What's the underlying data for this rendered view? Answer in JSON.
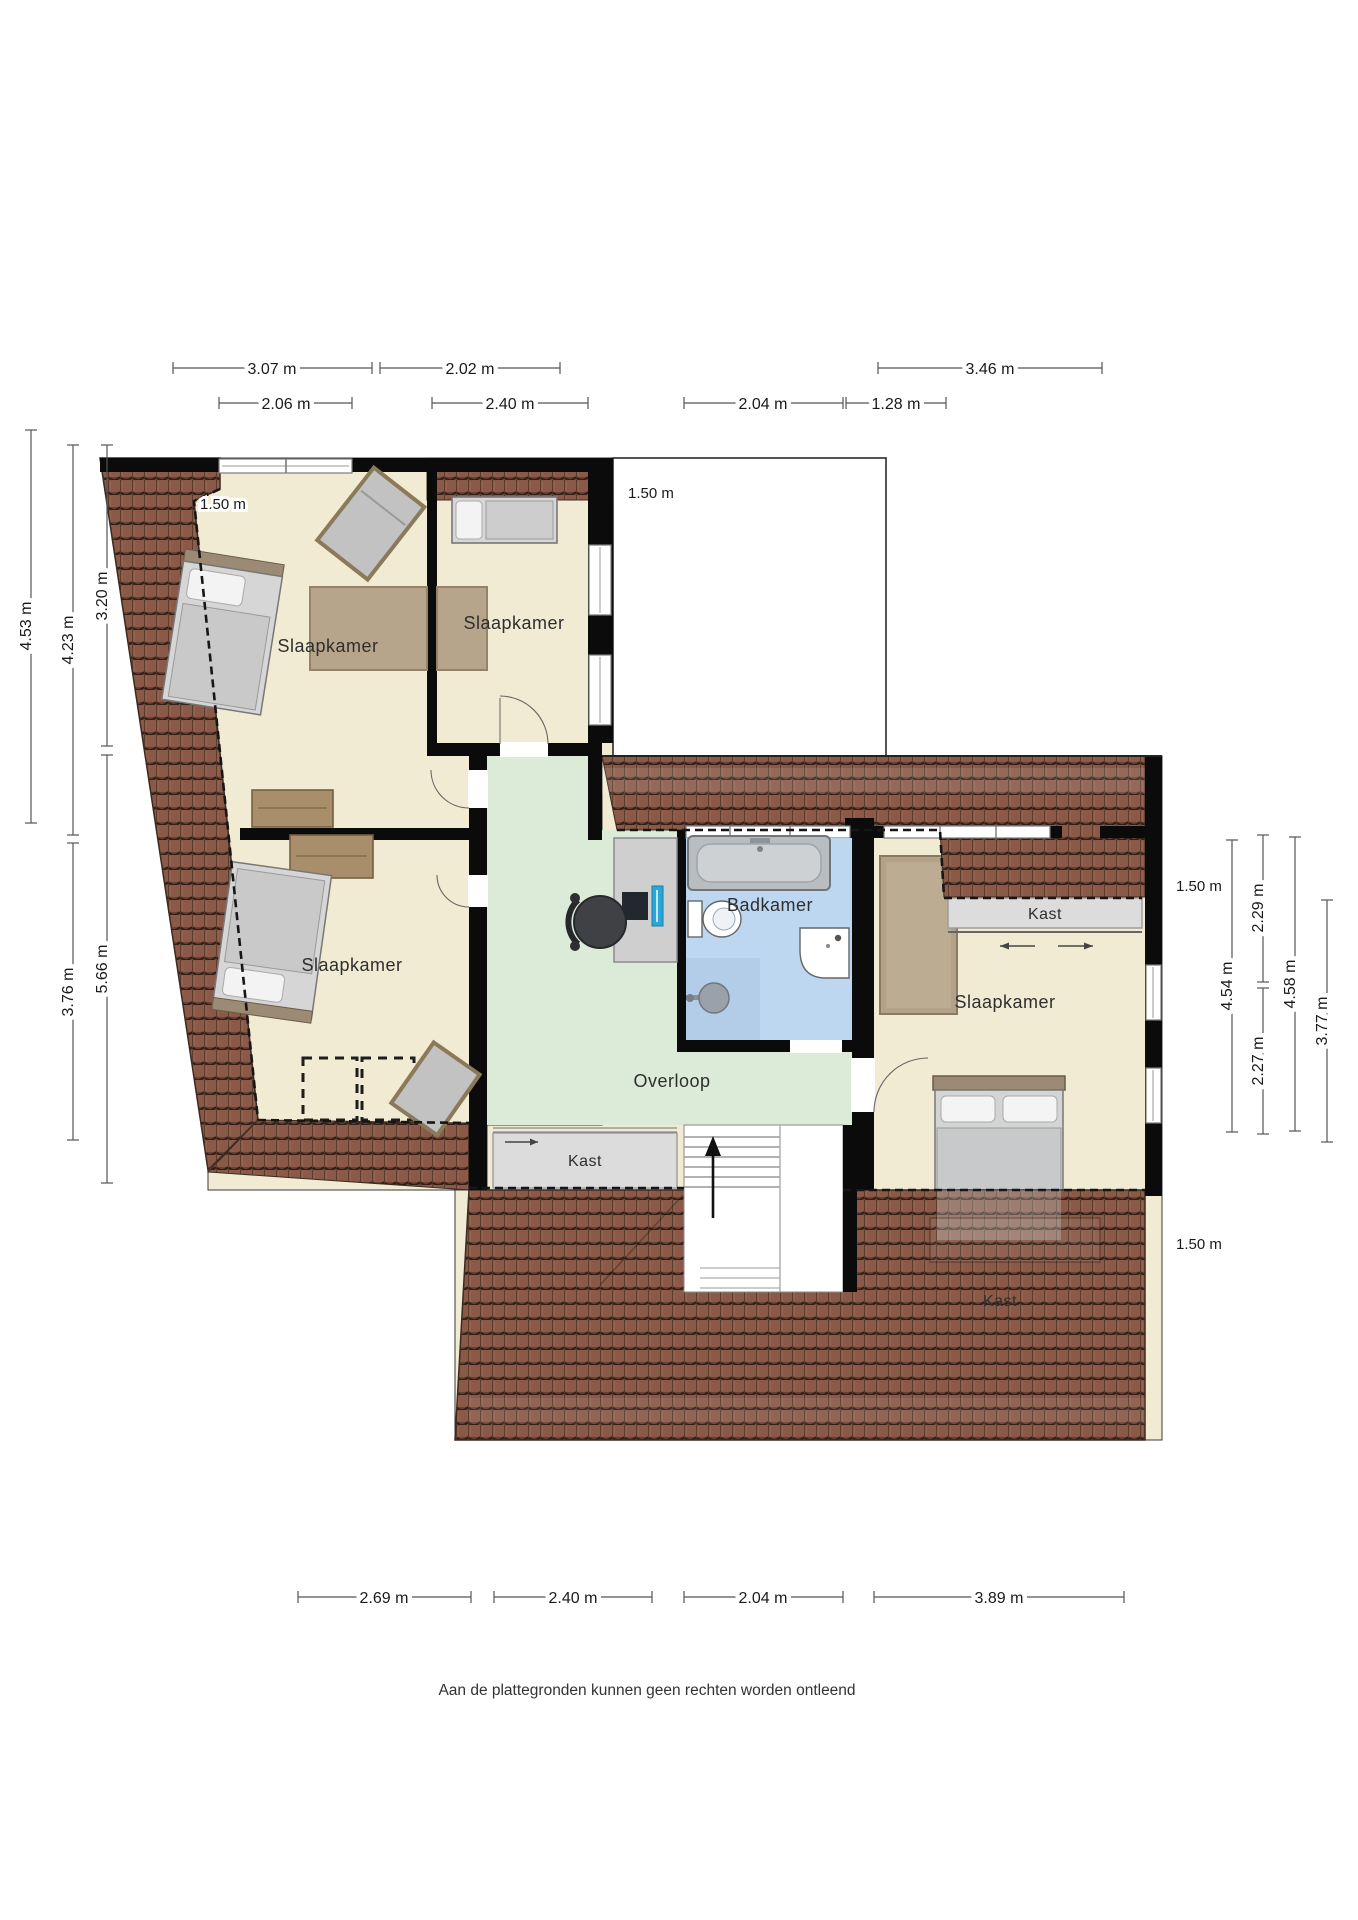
{
  "title": "Floor plan - upper storey (verdieping)",
  "rooms": {
    "bedroom_top_left": "Slaapkamer",
    "bedroom_middle": "Slaapkamer",
    "bedroom_bottom_left": "Slaapkamer",
    "bedroom_right": "Slaapkamer",
    "bathroom": "Badkamer",
    "landing": "Overloop"
  },
  "closets": {
    "left": "Kast",
    "right": "Kast",
    "under_roof": "Kast"
  },
  "headroom": {
    "top_left": "1.50 m",
    "void_edge": "1.50 m",
    "right_upper": "1.50 m",
    "right_lower": "1.50 m"
  },
  "dims": {
    "top_row1": [
      {
        "label": "3.07 m"
      },
      {
        "label": "2.02 m"
      },
      {
        "label": "3.46 m"
      }
    ],
    "top_row2": [
      {
        "label": "2.06 m"
      },
      {
        "label": "2.40 m"
      },
      {
        "label": "2.04 m"
      },
      {
        "label": "1.28 m"
      }
    ],
    "bottom": [
      {
        "label": "2.69 m"
      },
      {
        "label": "2.40 m"
      },
      {
        "label": "2.04 m"
      },
      {
        "label": "3.89 m"
      }
    ],
    "left": [
      {
        "label": "4.53 m"
      },
      {
        "label": "4.23 m"
      },
      {
        "label": "3.20 m"
      },
      {
        "label": "3.76 m"
      },
      {
        "label": "5.66 m"
      }
    ],
    "right": [
      {
        "label": "4.54 m"
      },
      {
        "label": "2.29 m"
      },
      {
        "label": "2.27 m"
      },
      {
        "label": "4.58 m"
      },
      {
        "label": "3.77 m"
      }
    ]
  },
  "footer": {
    "disclaimer": "Aan de plattegronden kunnen geen rechten worden ontleend"
  },
  "colors": {
    "roof_tile": "#8a5947",
    "roof_tile_dark": "#2e1f18",
    "floor_cream": "#f2ebd3",
    "landing_green": "#dcebd7",
    "bathroom_blue": "#bdd7f1",
    "shower_blue": "#b3cde9",
    "closet_gray": "#dcdcdc",
    "wall_black": "#0b0b0b",
    "monitor_teal": "#2aa7d8"
  }
}
